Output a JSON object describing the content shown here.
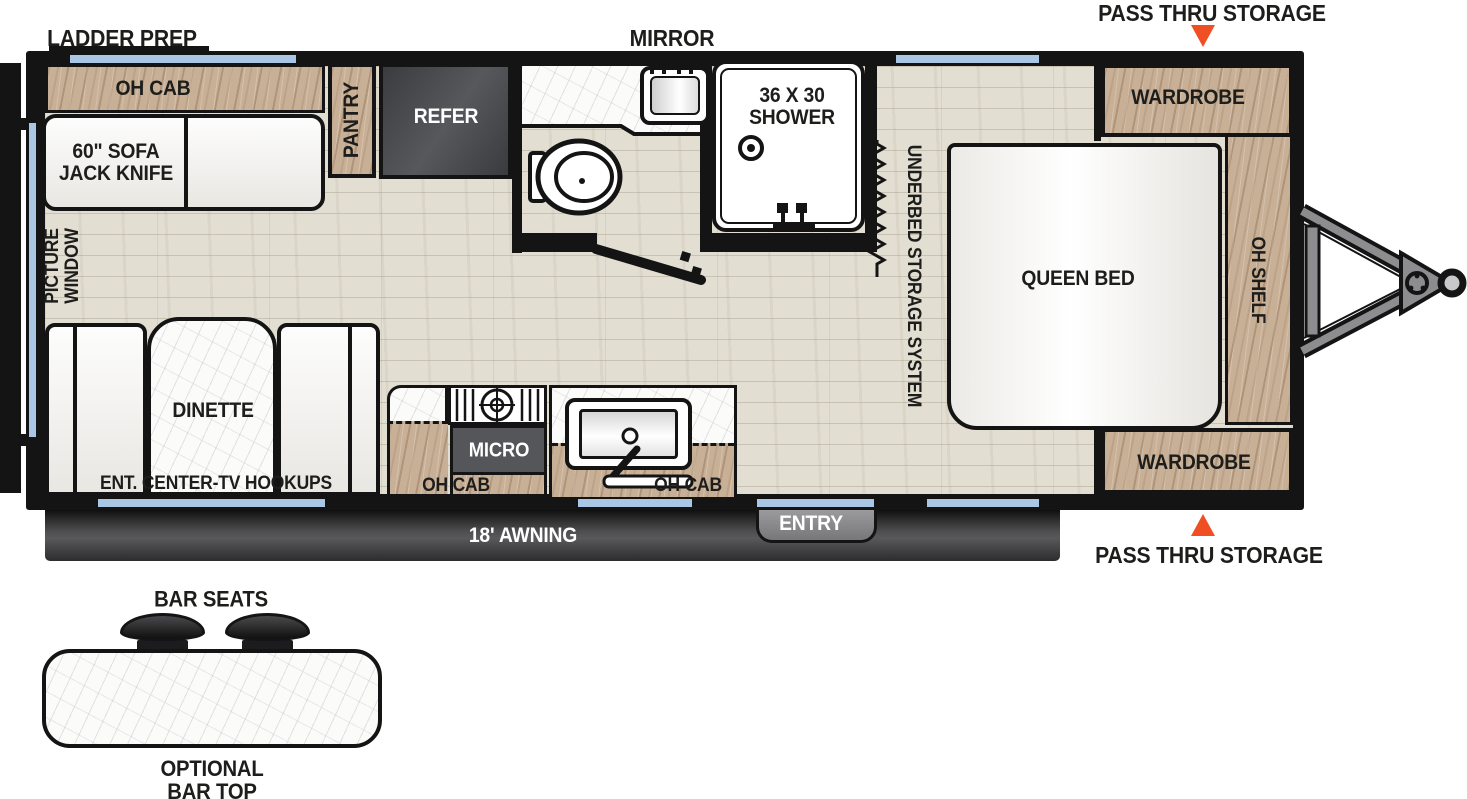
{
  "labels": {
    "ladder_prep": "LADDER PREP",
    "mirror": "MIRROR",
    "pass_thru_top": "PASS THRU STORAGE",
    "pass_thru_bottom": "PASS THRU STORAGE",
    "oh_cab_rear": "OH CAB",
    "sofa": "60\" SOFA\nJACK KNIFE",
    "pantry": "PANTRY",
    "refer": "REFER",
    "shower": "36 X 30\nSHOWER",
    "underbed": "UNDERBED STORAGE SYSTEM",
    "queen_bed": "QUEEN BED",
    "oh_shelf": "OH SHELF",
    "wardrobe_front_top": "WARDROBE",
    "wardrobe_front_bottom": "WARDROBE",
    "picture_window": "PICTURE\nWINDOW",
    "dinette": "DINETTE",
    "ent_center": "ENT. CENTER-TV HOOKUPS",
    "micro": "MICRO",
    "oh_cab_kitchen_left": "OH CAB",
    "oh_cab_kitchen_right": "OH CAB",
    "entry": "ENTRY",
    "awning": "18' AWNING",
    "bar_seats": "BAR SEATS",
    "optional_bar_top": "OPTIONAL\nBAR TOP"
  },
  "colors": {
    "accent_orange": "#F04E23",
    "window_blue": "#A9C7E4",
    "wood_cabinet": "#C8B096",
    "floor_wood": "#E3DED2",
    "appliance_dark": "#46474B",
    "wall_black": "#141414",
    "awning_gray": "#4C4C4E",
    "entry_gray": "#8E8E91"
  },
  "icons": {
    "pass_thru_arrow_down": "triangle-down",
    "pass_thru_arrow_up": "triangle-up",
    "toilet": "ellipse-outline",
    "shower_head": "double-circle",
    "stove_burner": "grate-with-circle",
    "door_swing": "diagonal-line",
    "bed_lift_spring": "zigzag",
    "trailer_hitch": "a-frame-tongue",
    "bar_stool": "dome",
    "window": "blue-strip"
  }
}
